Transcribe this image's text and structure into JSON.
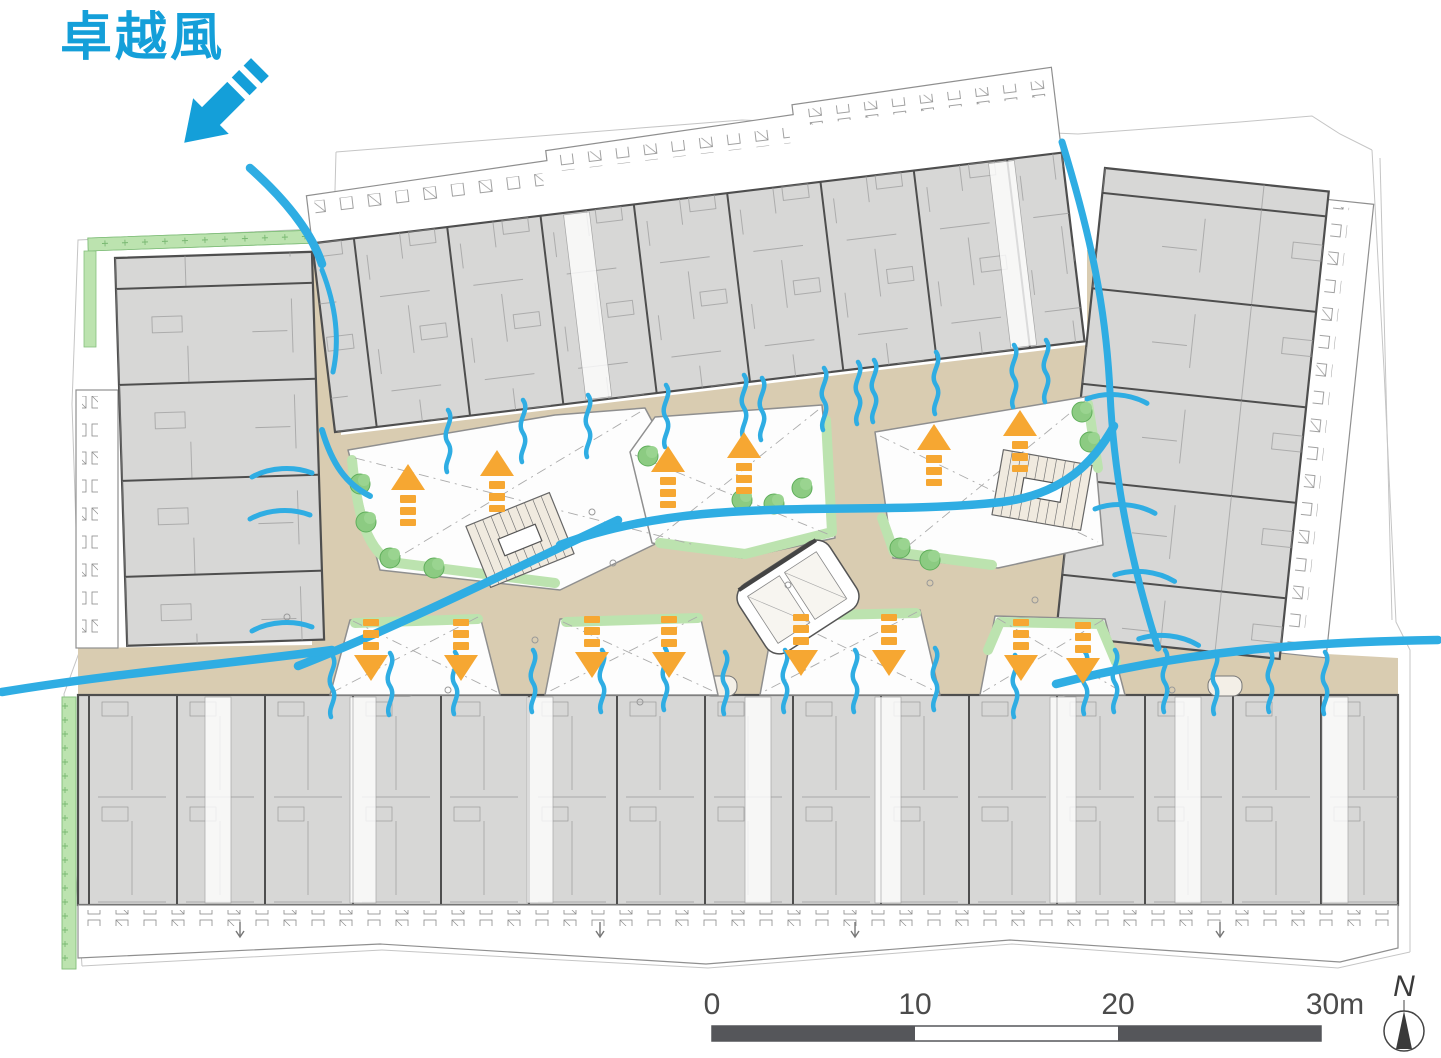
{
  "title": {
    "text": "卓越風"
  },
  "scalebar": {
    "ticks": [
      "0",
      "10",
      "20",
      "30m"
    ]
  },
  "compass": {
    "label": "N"
  },
  "colors": {
    "wind_blue": "#2FADE3",
    "label_blue": "#149FD9",
    "airflow_orange": "#F6A732",
    "ground_tan": "#D9CCB1",
    "greenery": "#BCE3AF",
    "tree_green": "#8CCB82",
    "building_fill": "#D7D7D6",
    "building_outline": "#4E4E4E",
    "scalebar_dark": "#55565A"
  },
  "airflow": {
    "up_arrows": 6,
    "down_arrows": 8
  },
  "icons": {
    "prevailing_wind_arrow": "thick-blue-arrow-pointing-southeast",
    "wind_stream": "curved-blue-stream-line",
    "wind_squiggle": "small-blue-s-curve",
    "up_arrow": "orange-dashed-arrow-up",
    "down_arrow": "orange-dashed-arrow-down",
    "north_arrow": "circle-with-needle-compass",
    "scale_bar": "alternating-bar-0-30m"
  }
}
